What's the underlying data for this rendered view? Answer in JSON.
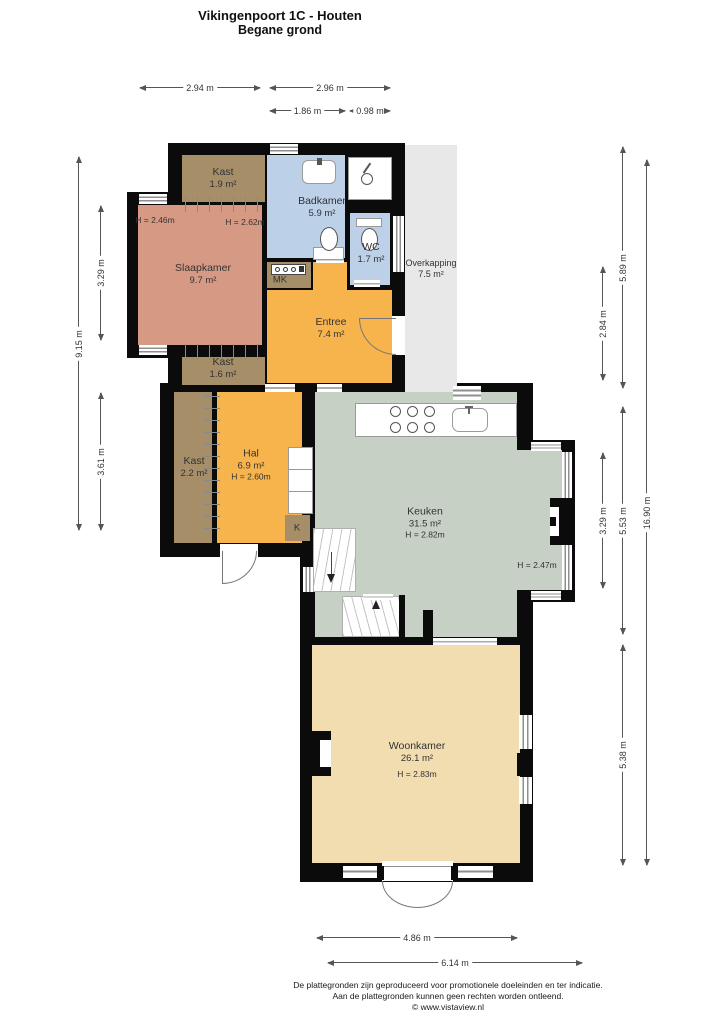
{
  "title": {
    "line1": "Vikingenpoort 1C - Houten",
    "line2": "Begane grond"
  },
  "rooms": {
    "kast_boven": {
      "name": "Kast",
      "area": "1.9 m²"
    },
    "badkamer": {
      "name": "Badkamer",
      "area": "5.9 m²"
    },
    "wc": {
      "name": "WC",
      "area": "1.7 m²"
    },
    "overkapping": {
      "name": "Overkapping",
      "area": "7.5 m²"
    },
    "slaapkamer": {
      "name": "Slaapkamer",
      "area": "9.7 m²",
      "h_left": "H = 2.46m",
      "h_right": "H = 2.62m"
    },
    "mk": {
      "name": "MK"
    },
    "entree": {
      "name": "Entree",
      "area": "7.4 m²"
    },
    "kast_midden": {
      "name": "Kast",
      "area": "1.6 m²"
    },
    "kast_hal": {
      "name": "Kast",
      "area": "2.2 m²"
    },
    "hal": {
      "name": "Hal",
      "area": "6.9 m²",
      "h": "H = 2.60m"
    },
    "k": {
      "name": "K"
    },
    "keuken": {
      "name": "Keuken",
      "area": "31.5 m²",
      "h": "H = 2.82m",
      "h2": "H = 2.47m"
    },
    "woonkamer": {
      "name": "Woonkamer",
      "area": "26.1 m²",
      "h": "H = 2.83m"
    }
  },
  "dimensions": {
    "top": {
      "d1": "2.94 m",
      "d2": "2.96 m",
      "d3": "1.86 m",
      "d4": "0.98 m"
    },
    "left": {
      "d1": "9.15 m",
      "d2": "3.29 m",
      "d3": "3.61 m"
    },
    "right": {
      "d1": "5.89 m",
      "d2": "2.84 m",
      "d3": "3.29 m",
      "d4": "5.53 m",
      "d5": "5.38 m",
      "d6": "16.90 m"
    },
    "bottom": {
      "d1": "4.86 m",
      "d2": "6.14 m"
    }
  },
  "footer": {
    "line1": "De plattegronden zijn geproduceerd voor promotionele doeleinden en ter indicatie.",
    "line2": "Aan de plattegronden kunnen geen rechten worden ontleend.",
    "line3": "© www.vistaview.nl"
  },
  "colors": {
    "wall": "#0b0b0b",
    "slaapkamer": "#d69a84",
    "kast": "#a58e68",
    "badkamer": "#bcd0e8",
    "entree_hal": "#f7b44d",
    "keuken": "#c6d0c4",
    "woonkamer": "#f2ddb0",
    "overkapping": "#e8e8e8"
  }
}
